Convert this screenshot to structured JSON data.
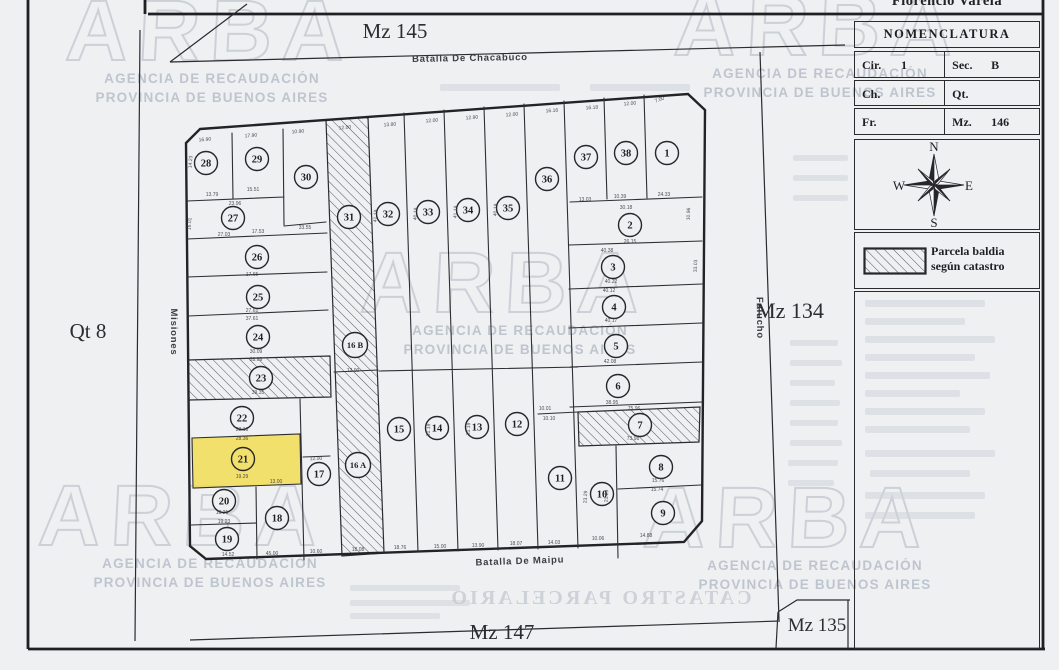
{
  "header": {
    "district": "Florencio Varela"
  },
  "nomenclatura": {
    "title": "NOMENCLATURA",
    "rows": [
      {
        "l": "Cir.",
        "lv": "1",
        "r": "Sec.",
        "rv": "B"
      },
      {
        "l": "Ch.",
        "lv": "",
        "r": "Qt.",
        "rv": ""
      },
      {
        "l": "Fr.",
        "lv": "",
        "r": "Mz.",
        "rv": "146"
      }
    ]
  },
  "compass": {
    "n": "N",
    "s": "S",
    "e": "E",
    "w": "W"
  },
  "legend": {
    "line1": "Parcela baldia",
    "line2": "según catastro"
  },
  "streets": [
    {
      "name": "Batalla De Chacabuco",
      "x": 470,
      "y": 61,
      "rotate": -1
    },
    {
      "name": "Batalla De Maipu",
      "x": 520,
      "y": 564,
      "rotate": -2
    },
    {
      "name": "Misiones",
      "x": 171,
      "y": 332,
      "rotate": 90
    },
    {
      "name": "Falucho",
      "x": 757,
      "y": 318,
      "rotate": 89
    }
  ],
  "blocks": [
    {
      "label": "Mz 145",
      "x": 395,
      "y": 38,
      "size": 21
    },
    {
      "label": "Mz 134",
      "x": 790,
      "y": 318,
      "size": 22
    },
    {
      "label": "Mz 147",
      "x": 502,
      "y": 639,
      "size": 21
    },
    {
      "label": "Mz 135",
      "x": 817,
      "y": 631,
      "size": 19
    },
    {
      "label": "Qt 8",
      "x": 88,
      "y": 338,
      "size": 21
    }
  ],
  "map": {
    "highlight_color": "#f2dd55",
    "parcels": [
      {
        "n": "1",
        "x": 667,
        "y": 153
      },
      {
        "n": "2",
        "x": 630,
        "y": 225
      },
      {
        "n": "3",
        "x": 613,
        "y": 267
      },
      {
        "n": "4",
        "x": 614,
        "y": 307
      },
      {
        "n": "5",
        "x": 616,
        "y": 346
      },
      {
        "n": "6",
        "x": 618,
        "y": 386
      },
      {
        "n": "7",
        "x": 640,
        "y": 425
      },
      {
        "n": "8",
        "x": 661,
        "y": 467
      },
      {
        "n": "9",
        "x": 663,
        "y": 513
      },
      {
        "n": "10",
        "x": 602,
        "y": 494
      },
      {
        "n": "11",
        "x": 560,
        "y": 478
      },
      {
        "n": "12",
        "x": 517,
        "y": 424
      },
      {
        "n": "13",
        "x": 477,
        "y": 427
      },
      {
        "n": "14",
        "x": 437,
        "y": 428
      },
      {
        "n": "15",
        "x": 399,
        "y": 429
      },
      {
        "n": "16 A",
        "x": 358,
        "y": 465,
        "wide": true
      },
      {
        "n": "16 B",
        "x": 355,
        "y": 345,
        "wide": true
      },
      {
        "n": "17",
        "x": 319,
        "y": 474
      },
      {
        "n": "18",
        "x": 277,
        "y": 518
      },
      {
        "n": "19",
        "x": 227,
        "y": 539
      },
      {
        "n": "20",
        "x": 224,
        "y": 501
      },
      {
        "n": "21",
        "x": 243,
        "y": 459,
        "highlight": true
      },
      {
        "n": "22",
        "x": 242,
        "y": 418
      },
      {
        "n": "23",
        "x": 261,
        "y": 378
      },
      {
        "n": "24",
        "x": 258,
        "y": 337
      },
      {
        "n": "25",
        "x": 258,
        "y": 297
      },
      {
        "n": "26",
        "x": 257,
        "y": 257
      },
      {
        "n": "27",
        "x": 233,
        "y": 218
      },
      {
        "n": "28",
        "x": 206,
        "y": 163
      },
      {
        "n": "29",
        "x": 257,
        "y": 159
      },
      {
        "n": "30",
        "x": 306,
        "y": 177
      },
      {
        "n": "31",
        "x": 349,
        "y": 217
      },
      {
        "n": "32",
        "x": 388,
        "y": 214
      },
      {
        "n": "33",
        "x": 428,
        "y": 212
      },
      {
        "n": "34",
        "x": 468,
        "y": 210
      },
      {
        "n": "35",
        "x": 508,
        "y": 208
      },
      {
        "n": "36",
        "x": 547,
        "y": 179
      },
      {
        "n": "37",
        "x": 586,
        "y": 157
      },
      {
        "n": "38",
        "x": 626,
        "y": 153
      }
    ],
    "dims": [
      [
        "16.90",
        205,
        141,
        -4
      ],
      [
        "17.90",
        251,
        137,
        -4
      ],
      [
        "10.90",
        298,
        133,
        -4
      ],
      [
        "12.00",
        345,
        129,
        -4
      ],
      [
        "13.80",
        390,
        126,
        -4
      ],
      [
        "12.00",
        432,
        122,
        -4
      ],
      [
        "12.90",
        472,
        119,
        -4
      ],
      [
        "12.00",
        512,
        116,
        -4
      ],
      [
        "16.16",
        552,
        112,
        -4
      ],
      [
        "16.18",
        592,
        109,
        -4
      ],
      [
        "12.00",
        630,
        105,
        -4
      ],
      [
        "7.00",
        660,
        101,
        -20
      ],
      [
        "14.52",
        228,
        556
      ],
      [
        "45.00",
        272,
        555
      ],
      [
        "10.60",
        316,
        553
      ],
      [
        "18.08",
        358,
        551
      ],
      [
        "18.76",
        400,
        549
      ],
      [
        "15.00",
        440,
        548
      ],
      [
        "13.90",
        478,
        547
      ],
      [
        "18.07",
        516,
        545
      ],
      [
        "14.03",
        554,
        544
      ],
      [
        "10.06",
        598,
        540
      ],
      [
        "14.88",
        646,
        537
      ],
      [
        "13.79",
        212,
        196
      ],
      [
        "15.51",
        253,
        191
      ],
      [
        "23.96",
        235,
        205
      ],
      [
        "33.55",
        305,
        229
      ],
      [
        "27.03",
        224,
        236
      ],
      [
        "17.53",
        258,
        233
      ],
      [
        "17.65",
        252,
        276
      ],
      [
        "27.61",
        252,
        312
      ],
      [
        "37.61",
        252,
        320
      ],
      [
        "30.09",
        256,
        353
      ],
      [
        "28.09",
        256,
        361
      ],
      [
        "39.35",
        258,
        394
      ],
      [
        "28.16",
        242,
        431
      ],
      [
        "28.36",
        242,
        440
      ],
      [
        "19.29",
        242,
        478
      ],
      [
        "13.00",
        276,
        483
      ],
      [
        "18.21",
        222,
        514
      ],
      [
        "19.23",
        224,
        523
      ],
      [
        "12.00",
        316,
        460,
        -2
      ],
      [
        "14.23",
        192,
        162,
        -86
      ],
      [
        "16.01",
        191,
        224,
        -86
      ],
      [
        "41.19",
        377,
        216,
        -87
      ],
      [
        "40.19",
        417,
        214,
        -87
      ],
      [
        "41.19",
        457,
        212,
        -87
      ],
      [
        "40.19",
        497,
        210,
        -87
      ],
      [
        "31.19",
        430,
        430,
        -87
      ],
      [
        "31.19",
        470,
        429,
        -87
      ],
      [
        "12.00",
        353,
        372
      ],
      [
        "13.03",
        585,
        201
      ],
      [
        "10.39",
        620,
        198
      ],
      [
        "24.33",
        664,
        196
      ],
      [
        "30.18",
        626,
        209
      ],
      [
        "26.15",
        630,
        243
      ],
      [
        "40.38",
        607,
        252
      ],
      [
        "40.22",
        611,
        283
      ],
      [
        "40.12",
        609,
        292
      ],
      [
        "40.17",
        611,
        322
      ],
      [
        "42.08",
        610,
        363
      ],
      [
        "38.95",
        612,
        404
      ],
      [
        "75.96",
        634,
        410
      ],
      [
        "73.98",
        633,
        440
      ],
      [
        "10.10",
        549,
        420
      ],
      [
        "10.01",
        545,
        410
      ],
      [
        "15.76",
        658,
        482
      ],
      [
        "15.74",
        657,
        491
      ],
      [
        "23.29",
        587,
        497,
        -87
      ],
      [
        "21.29",
        608,
        496,
        -87
      ],
      [
        "10.96",
        690,
        214,
        -88
      ],
      [
        "33.03",
        697,
        266,
        -88
      ]
    ]
  },
  "watermark": {
    "word": "ARBA",
    "line1": "AGENCIA DE RECAUDACIÓN",
    "line2": "PROVINCIA DE BUENOS AIRES",
    "positions": [
      {
        "x": 212,
        "y": 60
      },
      {
        "x": 820,
        "y": 55
      },
      {
        "x": 520,
        "y": 312
      },
      {
        "x": 210,
        "y": 545
      },
      {
        "x": 815,
        "y": 547
      }
    ]
  },
  "bleed": {
    "mirror_text": "CATASTRO PARCELARIO",
    "mirror_x": 600,
    "mirror_y": 604,
    "rects": [
      [
        865,
        300,
        120,
        7
      ],
      [
        865,
        318,
        100,
        7
      ],
      [
        865,
        336,
        130,
        7
      ],
      [
        865,
        354,
        110,
        7
      ],
      [
        865,
        372,
        125,
        7
      ],
      [
        865,
        390,
        95,
        7
      ],
      [
        865,
        408,
        120,
        7
      ],
      [
        865,
        426,
        105,
        7
      ],
      [
        865,
        450,
        130,
        7
      ],
      [
        870,
        470,
        100,
        7
      ],
      [
        865,
        492,
        120,
        7
      ],
      [
        865,
        512,
        110,
        7
      ],
      [
        790,
        340,
        48,
        6
      ],
      [
        790,
        360,
        52,
        6
      ],
      [
        790,
        380,
        45,
        6
      ],
      [
        790,
        400,
        50,
        6
      ],
      [
        790,
        420,
        48,
        6
      ],
      [
        790,
        440,
        52,
        6
      ],
      [
        788,
        460,
        50,
        6
      ],
      [
        788,
        480,
        46,
        6
      ],
      [
        793,
        155,
        55,
        6
      ],
      [
        793,
        175,
        55,
        6
      ],
      [
        793,
        195,
        55,
        6
      ],
      [
        440,
        84,
        120,
        7
      ],
      [
        590,
        84,
        100,
        7
      ],
      [
        350,
        585,
        110,
        6
      ],
      [
        350,
        600,
        120,
        6
      ],
      [
        350,
        613,
        90,
        6
      ]
    ]
  }
}
